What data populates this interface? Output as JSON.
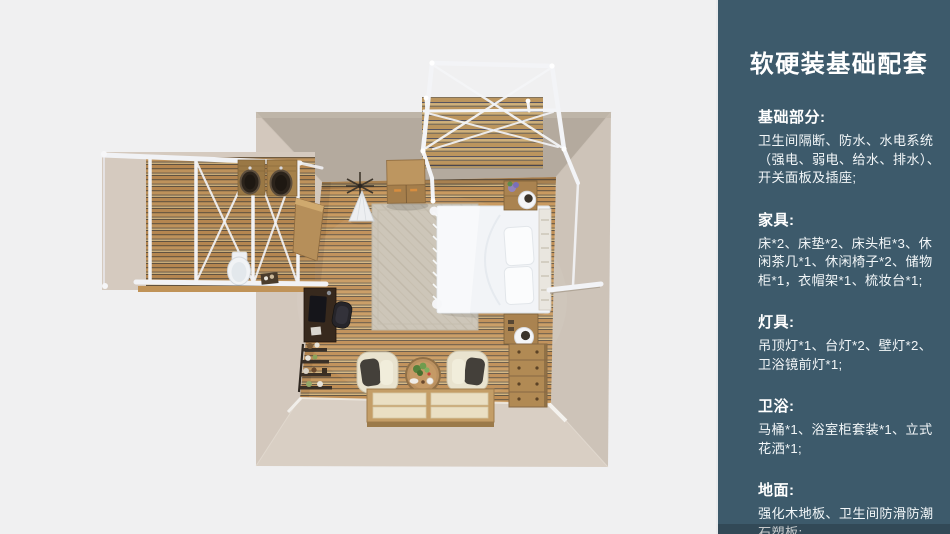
{
  "page": {
    "background": "#f0f0f1"
  },
  "sidebar": {
    "background": "#3d5a6b",
    "title": "软硬装基础配套",
    "sections": [
      {
        "heading": "基础部分:",
        "lines": [
          "卫生间隔断、防水、水电系统",
          "（强电、弱电、给水、排水）、",
          "开关面板及插座;"
        ]
      },
      {
        "heading": "家具:",
        "lines": [
          "床*2、床垫*2、床头柜*3、休",
          "闲茶几*1、休闲椅子*2、储物",
          "柜*1，衣帽架*1、梳妆台*1;"
        ]
      },
      {
        "heading": "灯具:",
        "lines": [
          "吊顶灯*1、台灯*2、壁灯*2、",
          "卫浴镜前灯*1;"
        ]
      },
      {
        "heading": "卫浴:",
        "lines": [
          "马桶*1、浴室柜套装*1、立式",
          "花洒*1;"
        ]
      },
      {
        "heading": "地面:",
        "lines": [
          "强化木地板、卫生间防滑防潮",
          "石塑板;"
        ]
      }
    ]
  },
  "floorplan": {
    "view": "top-down-3d-render",
    "areas": [
      "bedroom",
      "bathroom",
      "balcony-deck"
    ],
    "furniture": [
      "bed",
      "pillows",
      "headboard",
      "nightstand",
      "table-lamp",
      "wardrobe",
      "coat-rack",
      "canopy-cloth",
      "rug",
      "desk",
      "desk-chair",
      "ladder-shelf",
      "armchair",
      "tea-table",
      "tatami-platform",
      "dresser",
      "toilet",
      "vanity-basins",
      "glass-partition-frame",
      "deck"
    ],
    "colors": {
      "background": "#f0f0f1",
      "wall_top": "#b4aa9e",
      "wall_side": "#d3c8bd",
      "wall_bottom": "#d9cfc4",
      "floor_wood": "#bf8e55",
      "frame_white": "#f3f4f7",
      "bed_white": "#f2f4f7",
      "furniture_wood": "#b18a54"
    }
  }
}
